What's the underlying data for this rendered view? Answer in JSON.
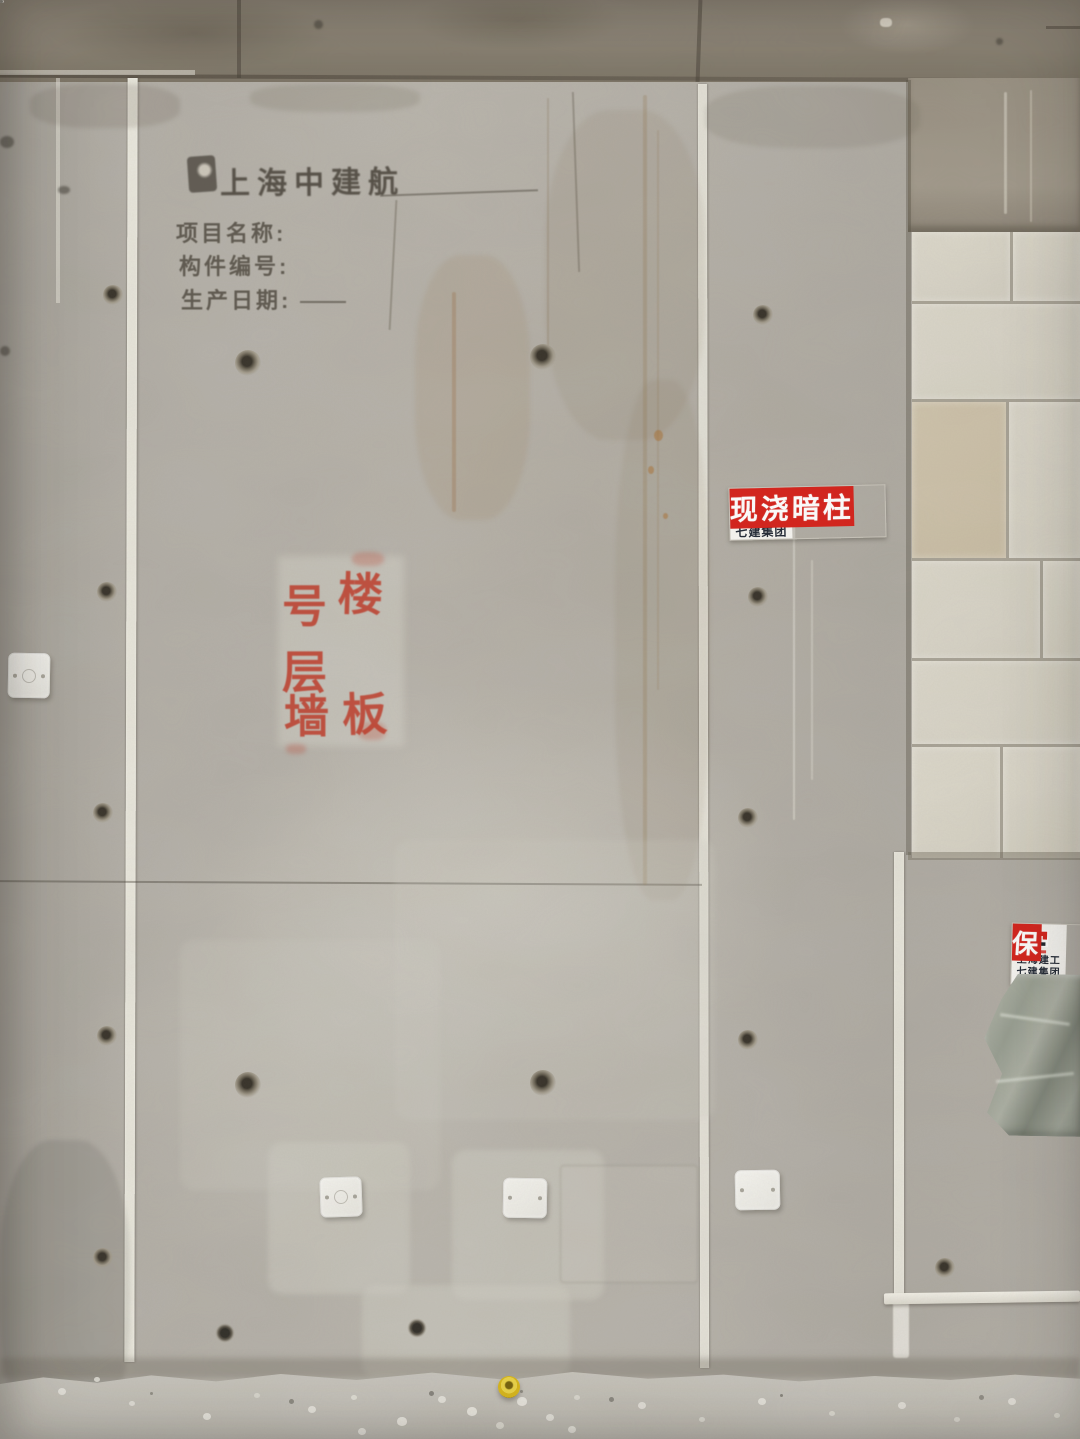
{
  "stamp": {
    "company": "上海中建航",
    "project_label": "项目名称:",
    "component_label": "构件编号:",
    "date_label": "生产日期:"
  },
  "stencil": {
    "hao": "号",
    "lou": "楼",
    "ceng": "层",
    "qiang": "墙",
    "ban": "板"
  },
  "signs": {
    "column_sign": {
      "org_line1": "上海建工",
      "org_line2": "七建集团",
      "label": "现浇暗柱"
    },
    "edge_sign": {
      "org_line1": "上海建工",
      "org_line2": "七建集团",
      "label_partial": "保"
    }
  },
  "colors": {
    "sign_red": "#d6231c",
    "stencil_red": "#bf3724",
    "cap_yellow": "#ddbb1c",
    "wall_gray": "#b6b2aa",
    "ceiling_gray": "#8d8577",
    "block_cream": "#dcd8cb"
  }
}
